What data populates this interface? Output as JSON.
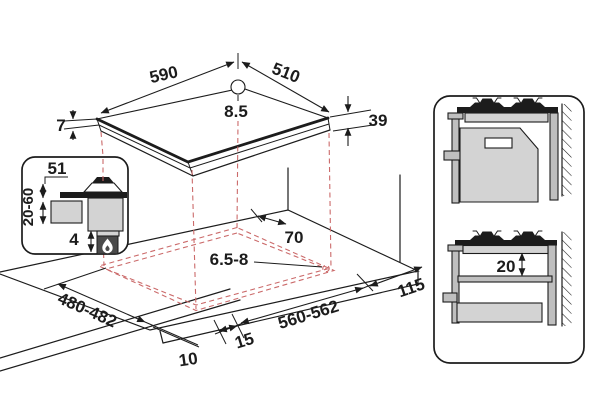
{
  "diagram": {
    "hob": {
      "width_mm": "590",
      "depth_mm": "510",
      "pan_support_height": "8.5",
      "glass_edge_height": "7",
      "body_height": "39"
    },
    "inset_detail": {
      "depth_below_top": "51",
      "worktop_thickness_range": "20-60",
      "bottom_clearance": "4"
    },
    "cutout": {
      "rear_distance": "70",
      "corner_radius": "6.5-8",
      "depth_range": "480-482",
      "width_range": "560-562",
      "right_distance": "115",
      "side_gap": "15",
      "front_gap": "10"
    },
    "side_view": {
      "shelf_clearance": "20"
    },
    "colors": {
      "line": "#1c1c1c",
      "dashed_red": "#cb6a6a",
      "fill_light": "#d3d3d3",
      "fill_mid": "#bfbfbf",
      "flame_box": "#4a4a4a"
    }
  }
}
